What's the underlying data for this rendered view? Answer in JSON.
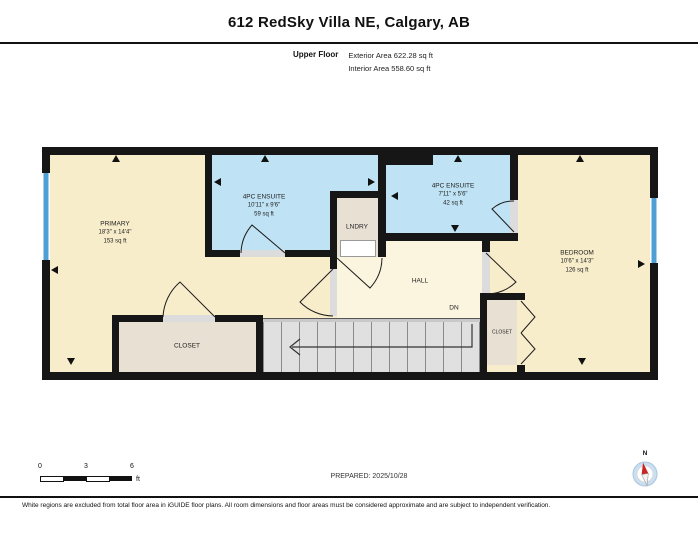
{
  "header": {
    "title": "612 RedSky Villa NE, Calgary, AB",
    "floor_label": "Upper Floor",
    "exterior_area": "Exterior Area 622.28 sq ft",
    "interior_area": "Interior Area 558.60 sq ft"
  },
  "rooms": {
    "primary": {
      "name": "PRIMARY",
      "dimensions": "18'3\" x 14'4\"",
      "area": "153 sq ft"
    },
    "ensuite_left": {
      "name": "4PC ENSUITE",
      "dimensions": "10'11\" x 9'6\"",
      "area": "59 sq ft"
    },
    "ensuite_right": {
      "name": "4PC ENSUITE",
      "dimensions": "7'11\" x 5'6\"",
      "area": "42 sq ft"
    },
    "bedroom": {
      "name": "BEDROOM",
      "dimensions": "10'6\" x 14'3\"",
      "area": "126 sq ft"
    },
    "laundry": {
      "name": "LNDRY"
    },
    "hall": {
      "name": "HALL"
    },
    "closet_left": {
      "name": "CLOSET"
    },
    "closet_right": {
      "name": "CLOSET"
    },
    "stairs_label": "DN"
  },
  "scale_bar": {
    "labels": [
      "0",
      "3",
      "6"
    ],
    "unit": "ft"
  },
  "footer": {
    "prepared": "PREPARED: 2025/10/28",
    "compass_label": "N",
    "disclaimer": "White regions are excluded from total floor area in iGUIDE floor plans. All room dimensions and floor areas must be considered approximate and are subject to independent verification."
  },
  "colors": {
    "wall": "#161616",
    "room_cream": "#F8EDCA",
    "hall_cream": "#FBF4DE",
    "room_blue": "#BFE3F5",
    "closet_beige": "#E8E0D3",
    "stairs_gray": "#E0E0E0",
    "window_blue": "#4D9FD6",
    "compass_red": "#CC2222"
  }
}
